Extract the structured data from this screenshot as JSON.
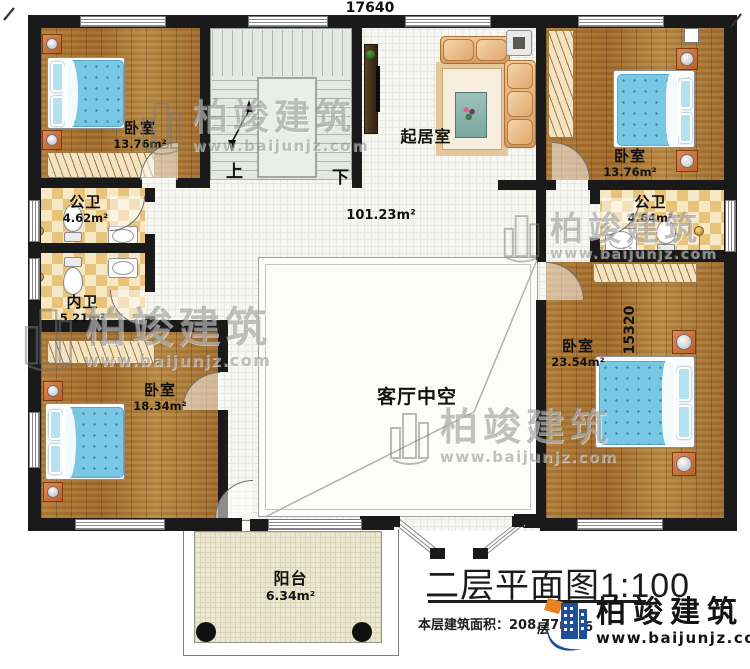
{
  "dimensions": {
    "top": "17640",
    "right": "15320"
  },
  "rooms": {
    "bedroom_top_left": {
      "name": "卧室",
      "area": "13.76m²"
    },
    "bedroom_top_right": {
      "name": "卧室",
      "area": "13.76m²"
    },
    "public_bath_left": {
      "name": "公卫",
      "area": "4.62m²"
    },
    "private_bath_left": {
      "name": "内卫",
      "area": "5.21m²"
    },
    "bedroom_bottom_left": {
      "name": "卧室",
      "area": "18.34m²"
    },
    "bedroom_right": {
      "name": "卧室",
      "area": "23.54m²"
    },
    "public_bath_right": {
      "name": "公卫",
      "area": "4.64m²"
    },
    "living_room": {
      "name": "起居室"
    },
    "hallway": {
      "area": "101.23m²"
    },
    "living_void": {
      "name": "客厅中空"
    },
    "balcony": {
      "name": "阳台",
      "area": "6.34m²"
    }
  },
  "stairs": {
    "up_label": "上",
    "down_label": "下"
  },
  "watermark": {
    "brand": "柏竣建筑",
    "url": "www.baijunjz.com"
  },
  "title_block": {
    "title": "二层平面图1:100",
    "area_label": "本层建筑面积：",
    "area_value": "208.77m²",
    "obscured_fragments": {
      "left": "层",
      "right": "6"
    }
  },
  "logo": {
    "brand": "柏竣建筑",
    "url": "www.baijunjz.com"
  },
  "colors": {
    "wall": "#1a1a1a",
    "wood_floor": "#ac7533",
    "bath_checker": "#e7c37c",
    "mattress_blue": "#76c6e2",
    "stair_floor": "#e3e8e2",
    "balcony_floor": "#ebe7d0",
    "logo_blue": "#1d4f9e",
    "logo_orange": "#e8821e"
  }
}
